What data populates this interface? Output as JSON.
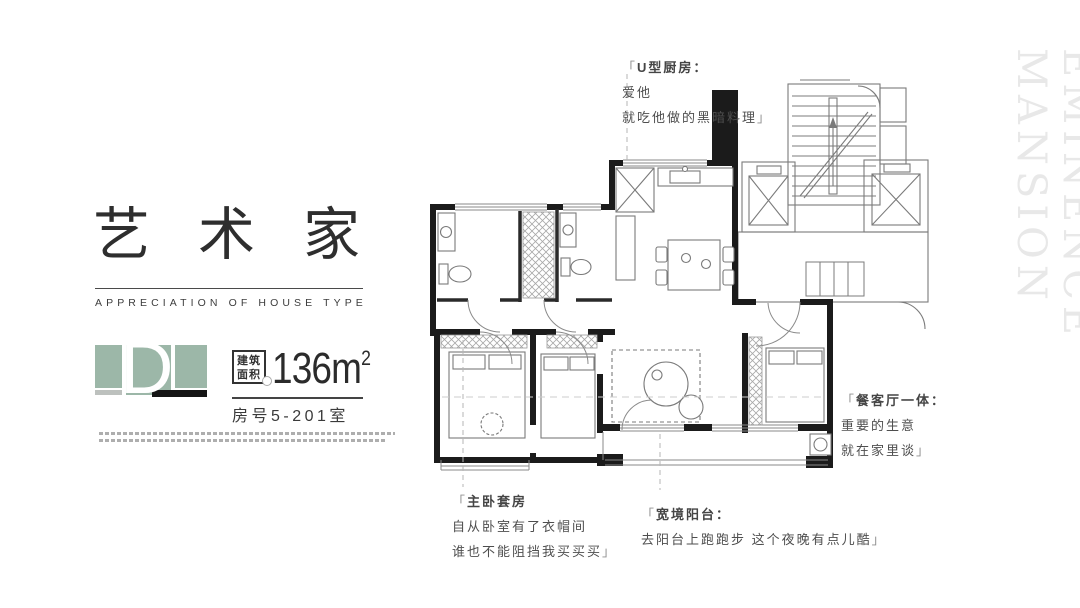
{
  "left_panel": {
    "title": "艺术家",
    "subtitle": "APPRECIATION OF HOUSE TYPE",
    "logo_letter": "D",
    "area_badge_line1": "建筑",
    "area_badge_line2": "面积",
    "area_value": "136m",
    "area_exponent": "2",
    "room_number": "房号5-201室"
  },
  "annotations": {
    "kitchen": {
      "bracket_open": "「",
      "title": "U型厨房：",
      "line1": "爱他",
      "line2": "就吃他做的黑暗料理",
      "bracket_close": "」"
    },
    "master": {
      "bracket_open": "「",
      "title": "主卧套房",
      "line1": "自从卧室有了衣帽间",
      "line2": "谁也不能阻挡我买买买",
      "bracket_close": "」"
    },
    "balcony": {
      "bracket_open": "「",
      "title": "宽境阳台：",
      "line1": "去阳台上跑跑步  这个夜晚有点儿酷",
      "bracket_close": "」"
    },
    "dining": {
      "bracket_open": "「",
      "title": "餐客厅一体：",
      "line1": "重要的生意",
      "line2": "就在家里谈",
      "bracket_close": "」"
    }
  },
  "watermark": "EMINENCE MANSION",
  "colors": {
    "logo_green": "#9cb7a8",
    "logo_gray_strip": "#bdc1be",
    "wall_black": "#1b1b1b",
    "text_dark": "#2e2e2e",
    "annotation_gray": "#4e4e4e",
    "watermark_gray": "#e8e8e8"
  }
}
